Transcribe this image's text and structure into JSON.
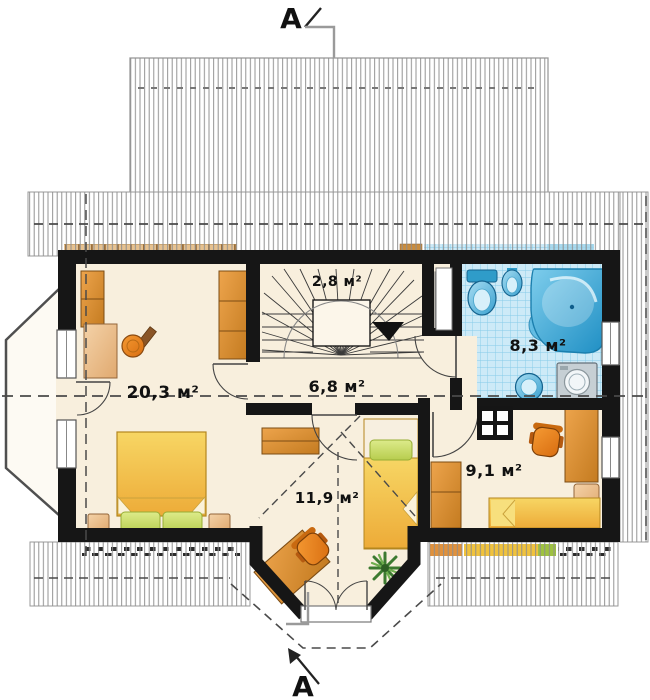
{
  "drawing": {
    "section_markers": {
      "top": "A",
      "bottom": "A"
    }
  },
  "rooms": [
    {
      "key": "bedroom-left",
      "area_label": "20,3 м²"
    },
    {
      "key": "staircase",
      "area_label": "2,8 м²"
    },
    {
      "key": "hallway",
      "area_label": "6,8 м²"
    },
    {
      "key": "bathroom",
      "area_label": "8,3 м²"
    },
    {
      "key": "bedroom-right",
      "area_label": "9,1 м²"
    },
    {
      "key": "bedroom-bay",
      "area_label": "11,9 м²"
    }
  ],
  "icons": {
    "stair_direction": "down-arrow-triangle",
    "furniture": {
      "bedroom_left": [
        "wardrobe",
        "wardrobe",
        "dressing-table",
        "stool",
        "double-bed",
        "pillow-bench",
        "bedside-table",
        "bedside-table"
      ],
      "bedroom_bay": [
        "wall-shelf",
        "desk",
        "office-chair",
        "single-bed",
        "potted-plant"
      ],
      "bedroom_right": [
        "wardrobe",
        "desk",
        "office-chair",
        "side-table",
        "single-bed"
      ],
      "bathroom": [
        "corner-bathtub",
        "toilet",
        "bidet",
        "washbasin",
        "washing-machine",
        "duct-panel"
      ]
    },
    "roof_areas": [
      "upper-dormer",
      "top-eaves",
      "right-eaves",
      "bottom-left-eaves",
      "bottom-right-eaves",
      "side-dormer"
    ]
  },
  "colors": {
    "wall": "#161616",
    "floor": "#f8efdd",
    "roof_hatch": "#8e8e8e",
    "wood": "#d98a33",
    "wood_light": "#ecc296",
    "bed_yellow": "#f2bc3f",
    "pillow_green": "#cbdc6a",
    "chair_orange": "#e8821e",
    "tile_blue": "#cdeaf7",
    "fixture_blue": "#39a0cf",
    "dashed_line": "#4a4a4a"
  }
}
